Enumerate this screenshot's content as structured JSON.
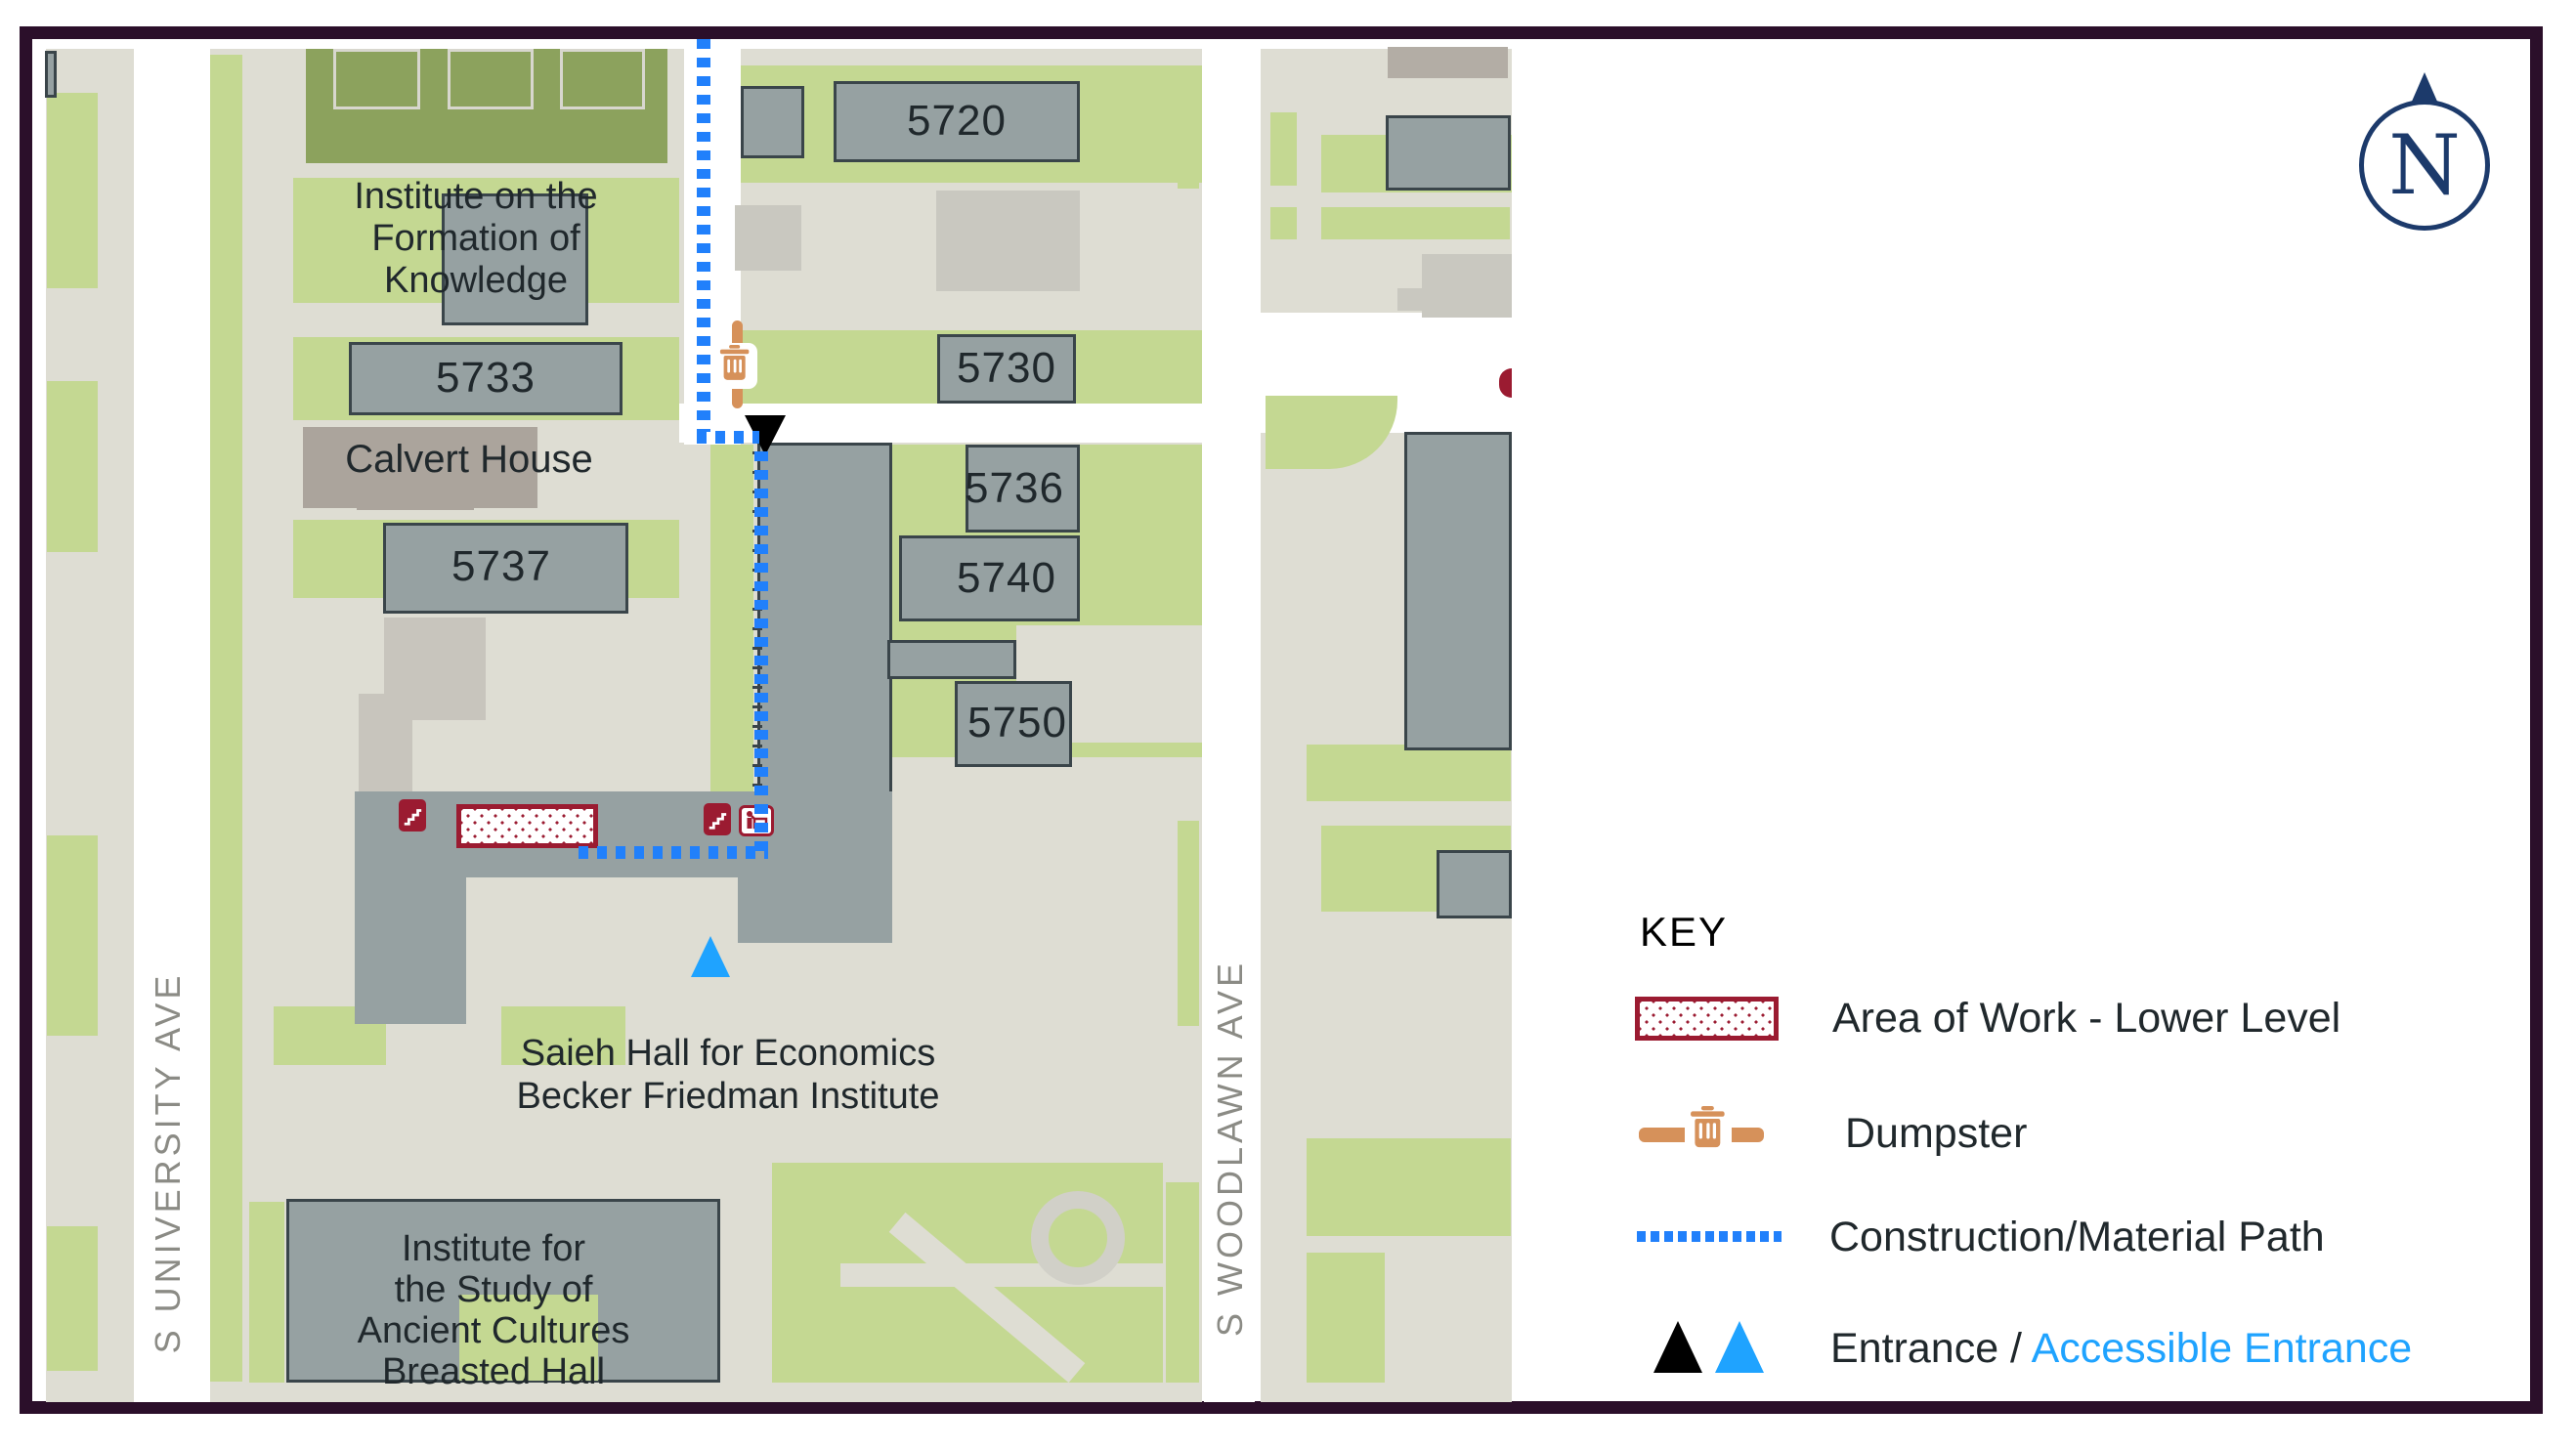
{
  "colors": {
    "frame": "#2B0F2A",
    "bg": "#DEDDD3",
    "green": "#C4D892",
    "field": "#8CA25D",
    "court": "#D8D7CE",
    "bld": "#96A1A2",
    "outline": "#3A454A",
    "lightbld": "#C9C8C0",
    "tan": "#ABA49C",
    "church": "#C8C5BD",
    "tan2": "#B3ADA5",
    "maroon": "#9B1B31",
    "orange": "#D6915A",
    "pathBlue": "#2180FB",
    "accessBlue": "#1FA3FF",
    "navy": "#1C3A6B",
    "text": "#20282C",
    "streetLabel": "#8B8B85",
    "ring": "#D1D0C8",
    "white": "#FFFFFF"
  },
  "map": {
    "street_left": "S UNIVERSITY AVE",
    "street_right": "S WOODLAWN AVE",
    "compass_letter": "N",
    "labels": {
      "b5720": "5720",
      "b5730": "5730",
      "b5733": "5733",
      "b5736": "5736",
      "b5737": "5737",
      "b5740": "5740",
      "b5750": "5750",
      "ifk_1": "Institute on the",
      "ifk_2": "Formation of",
      "ifk_3": "Knowledge",
      "calvert": "Calvert House",
      "saieh_1": "Saieh Hall for Economics",
      "saieh_2": "Becker Friedman Institute",
      "isac_1": "Institute for",
      "isac_2": "the Study of",
      "isac_3": "Ancient Cultures",
      "isac_4": "Breasted Hall"
    },
    "icons": {
      "dumpster": "trash-can-icon",
      "entrance": "black-triangle-icon",
      "accessible_entrance": "blue-triangle-icon",
      "stairs": "stairs-icon",
      "elevator": "elevator-icon",
      "compass": "north-compass-icon"
    }
  },
  "key": {
    "title": "KEY",
    "area_of_work": "Area of Work - Lower Level",
    "dumpster": "Dumpster",
    "construction_path": "Construction/Material Path",
    "entrance": "Entrance / ",
    "accessible_entrance": "Accessible Entrance"
  }
}
